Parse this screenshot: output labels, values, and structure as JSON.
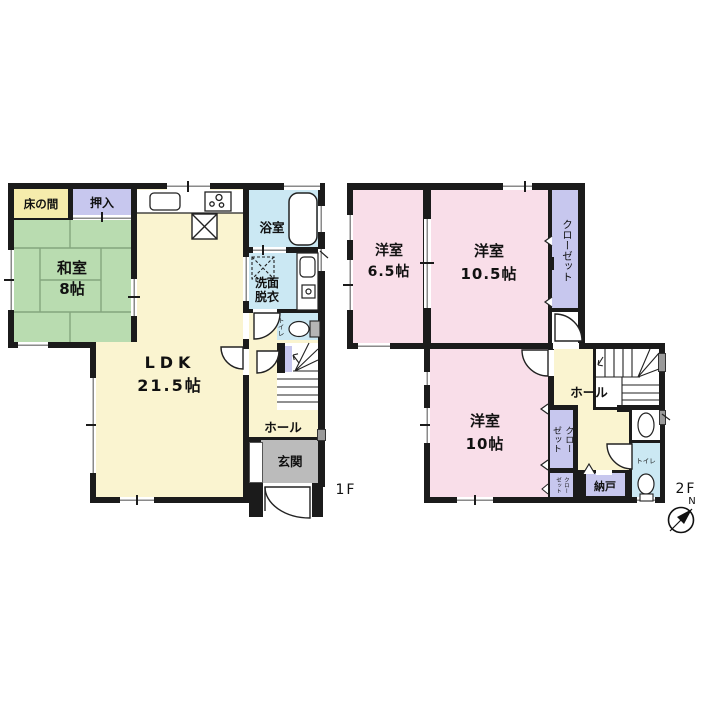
{
  "f1": {
    "label": "1F",
    "tokonoma": "床の間",
    "oshiire": "押入",
    "washitsu_name": "和室",
    "washitsu_size": "8帖",
    "ldk_name": "LDK",
    "ldk_size": "21.5帖",
    "bath": "浴室",
    "wash1": "洗面",
    "wash2": "脱衣",
    "toilet": "トイレ",
    "hall": "ホール",
    "genkan": "玄関"
  },
  "f2": {
    "label": "2F",
    "r65_name": "洋室",
    "r65_size": "6.5帖",
    "r105_name": "洋室",
    "r105_size": "10.5帖",
    "closet": "クローゼット",
    "hall": "ホール",
    "r10_name": "洋室",
    "r10_size": "10帖",
    "closet2_left": "ゼット",
    "closet2_right": "クロー",
    "closet3_left": "ゼット",
    "closet3_right": "クロー",
    "nando": "納戸",
    "toilet": "トイレ"
  },
  "compass": {
    "n": "N"
  },
  "colors": {
    "wall": "#1b1b1b",
    "tatami_green": "#B9DCB0",
    "room_yellow": "#FAF4D0",
    "wet_blue": "#CBE8F3",
    "bedroom_pink": "#F9DEE9",
    "closet_lavender": "#C7C7EE",
    "tokonoma_cream": "#F6ECAC",
    "genkan_gray": "#BBBBBB"
  }
}
